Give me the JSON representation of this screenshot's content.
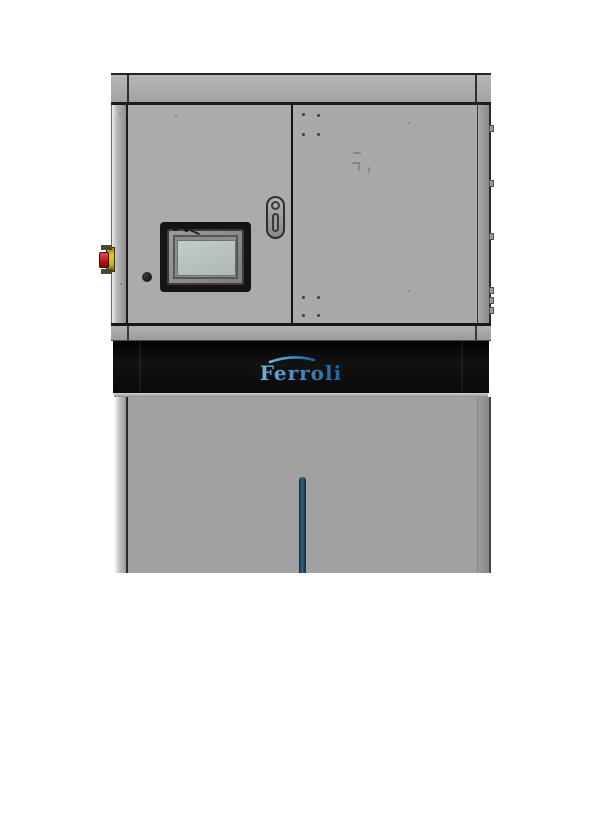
{
  "image": {
    "kind": "product-render",
    "subject": "Ferroli floor-standing heating unit cabinet with HMI touch panel",
    "background_color": "#ffffff"
  },
  "machine": {
    "brand_label": "Ferroli",
    "colors": {
      "cabinet_gray": "#a9a9a9",
      "lower_panel_gray": "#a1a1a1",
      "brand_band_black": "#0a0a0a",
      "logo_blue_light": "#6db3e0",
      "logo_blue_dark": "#1862a0",
      "hmi_screen_green_gray": "#b9c4bf",
      "estop_red": "#c0201c",
      "estop_yellow": "#d8c419",
      "handle_groove_teal": "#2e6a86"
    }
  }
}
